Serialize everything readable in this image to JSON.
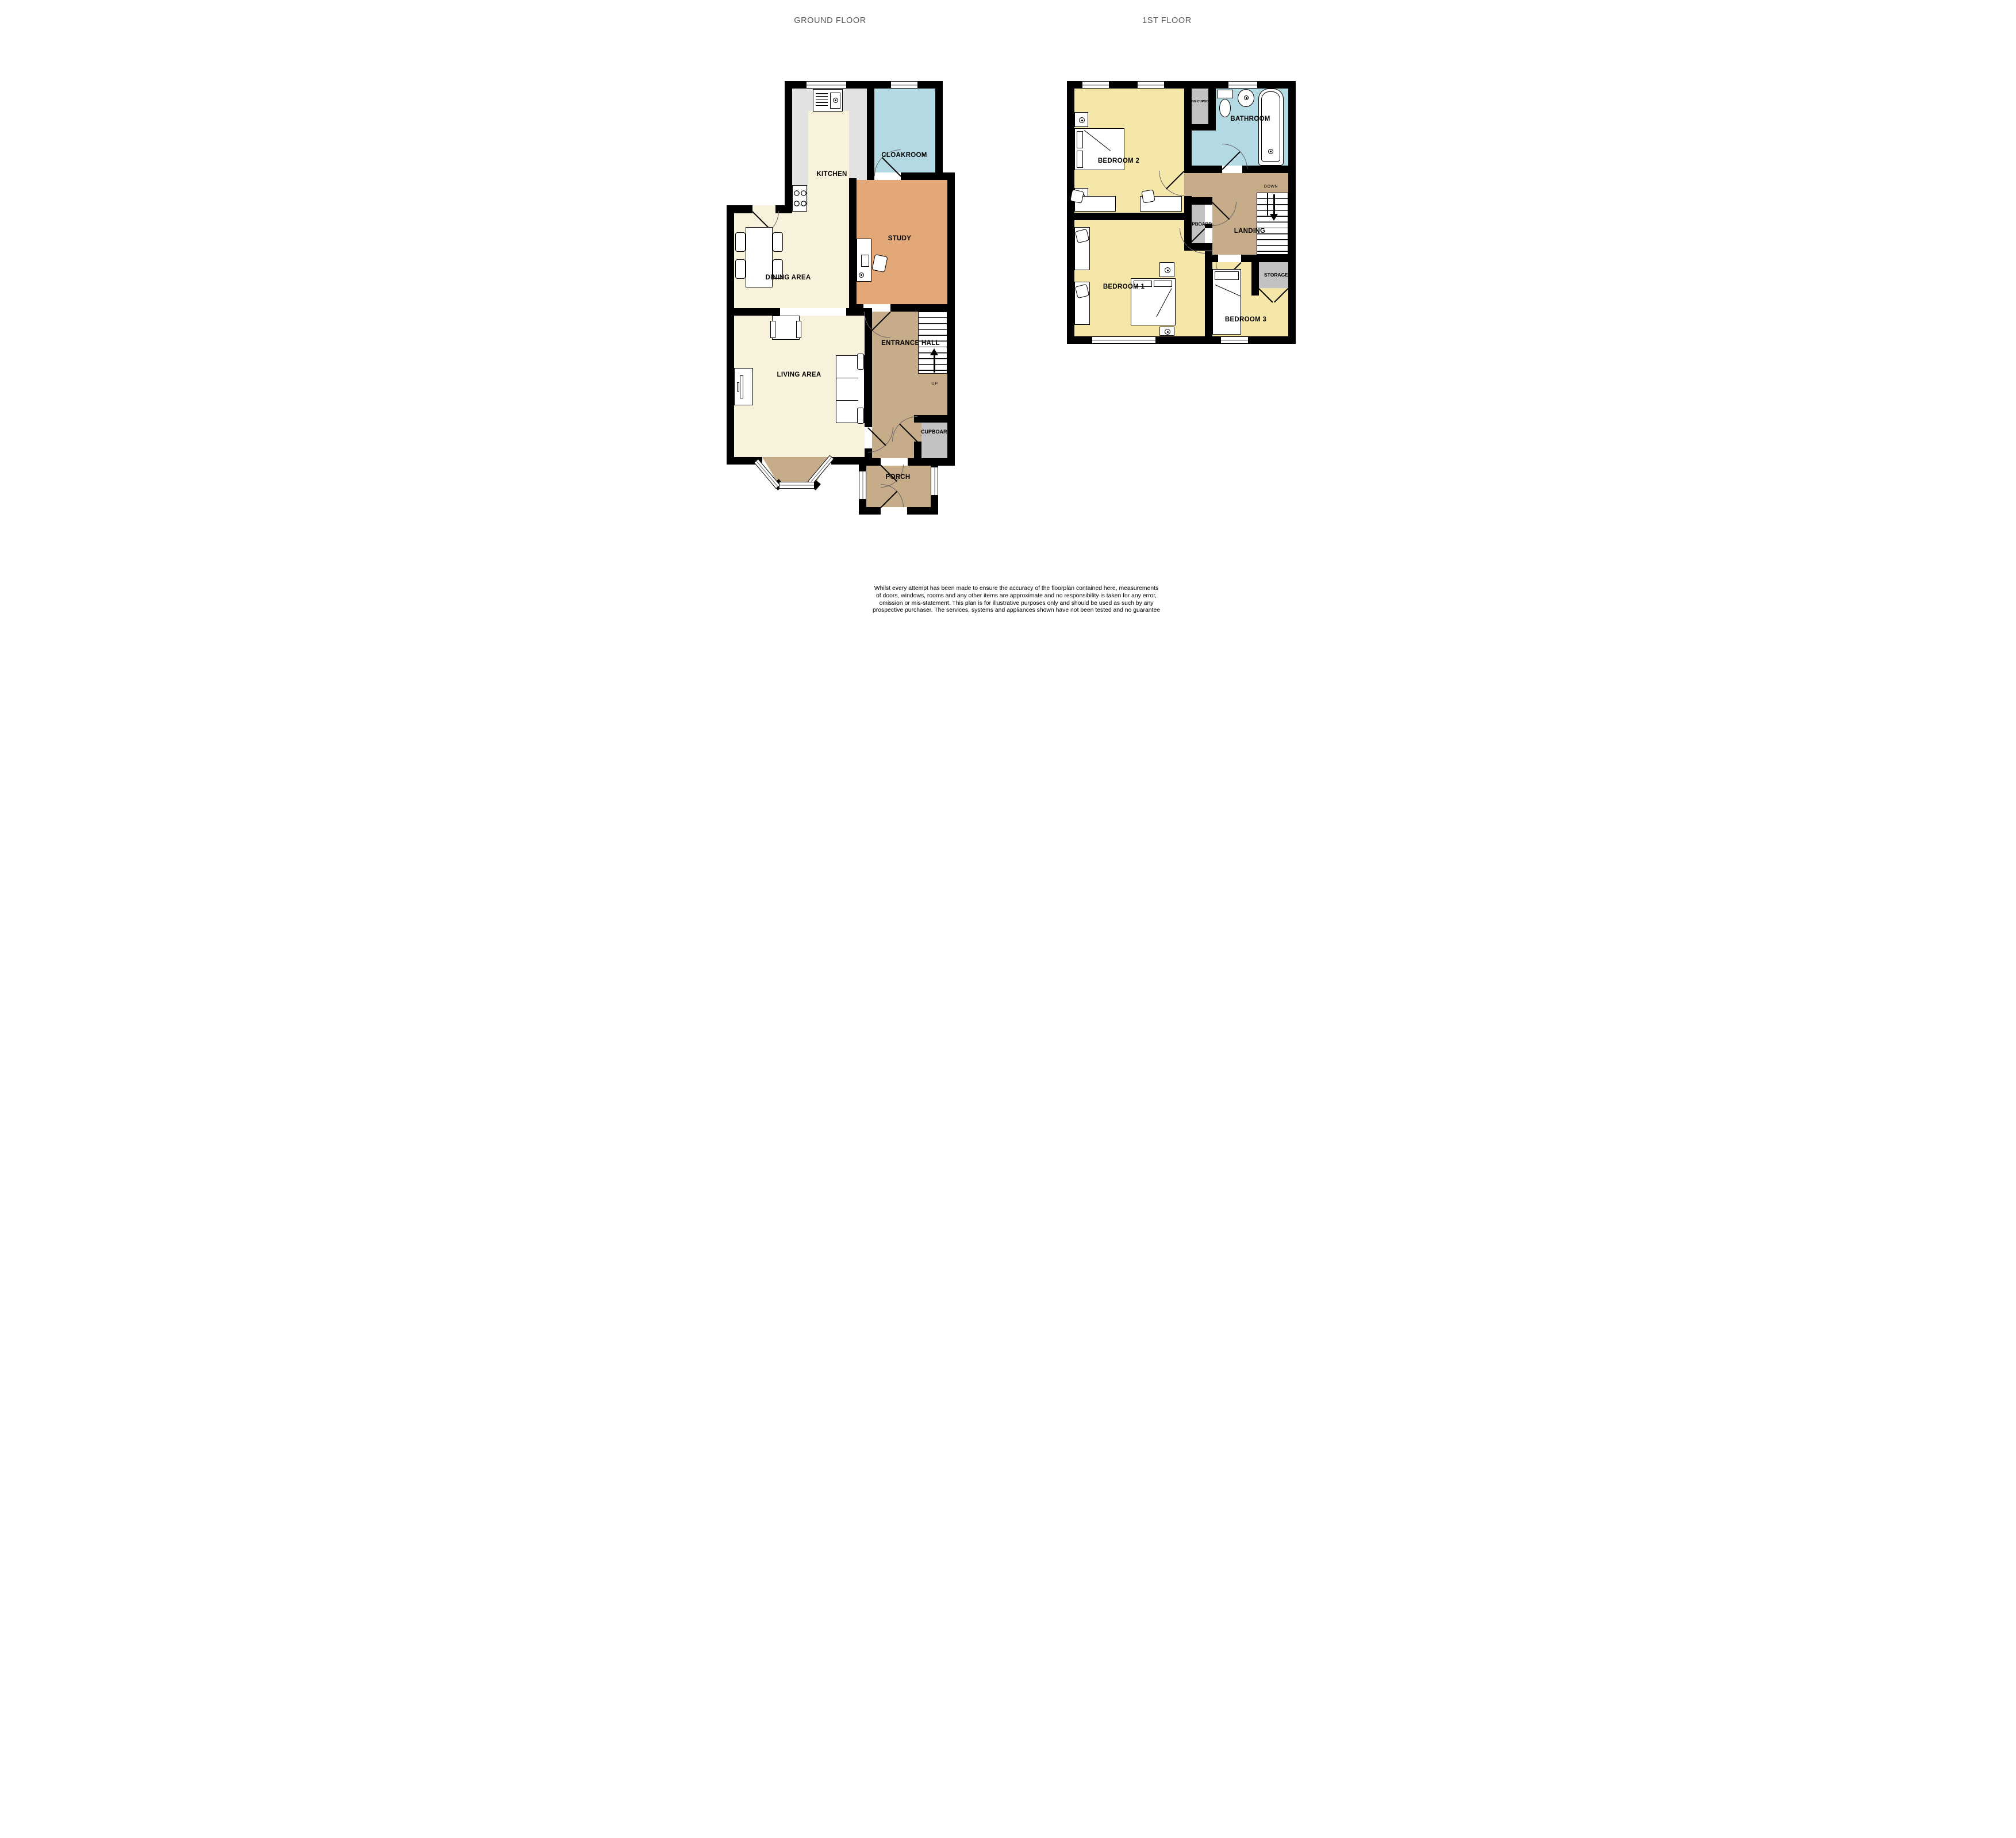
{
  "titles": {
    "ground_floor": "GROUND FLOOR",
    "first_floor": "1ST FLOOR"
  },
  "ground_floor": {
    "labels": {
      "kitchen": "KITCHEN",
      "cloakroom": "CLOAKROOM",
      "dining_area": "DINING AREA",
      "study": "STUDY",
      "living_area": "LIVING AREA",
      "entrance_hall": "ENTRANCE HALL",
      "cupboard": "CUPBOARD",
      "porch": "PORCH",
      "stairs_direction": "UP"
    }
  },
  "first_floor": {
    "labels": {
      "bedroom_1": "BEDROOM 1",
      "bedroom_2": "BEDROOM 2",
      "bedroom_3": "BEDROOM 3",
      "bathroom": "BATHROOM",
      "airing_cupboard": "AIRING CUPBOARD",
      "cupboard": "CUPBOARD",
      "landing": "LANDING",
      "storage": "STORAGE",
      "stairs_direction": "DOWN"
    }
  },
  "footer": {
    "disclaimer_lines": [
      "Whilst every attempt has been made to ensure the accuracy of the floorplan contained here, measurements",
      "of doors, windows, rooms and any other items are approximate and no responsibility is taken for any error,",
      "omission or mis-statement. This plan is for illustrative purposes only and should be used as such by any",
      "prospective purchaser. The services, systems and appliances shown have not been tested and no guarantee",
      "as to their operability or efficiency can be given.",
      "Made with Metropix ©2024"
    ]
  },
  "colors": {
    "wall": "#000000",
    "floor_cream": "#F8F2DC",
    "floor_bedroom_yellow": "#F5E7A9",
    "floor_bathroom_blue": "#B3D9E2",
    "floor_study_orange": "#E3A878",
    "floor_hall_tan": "#C7AC8A",
    "kitchen_counter_gray": "#E2E2E2",
    "cupboard_gray": "#C2C2C5",
    "title_gray": "#57585B"
  }
}
